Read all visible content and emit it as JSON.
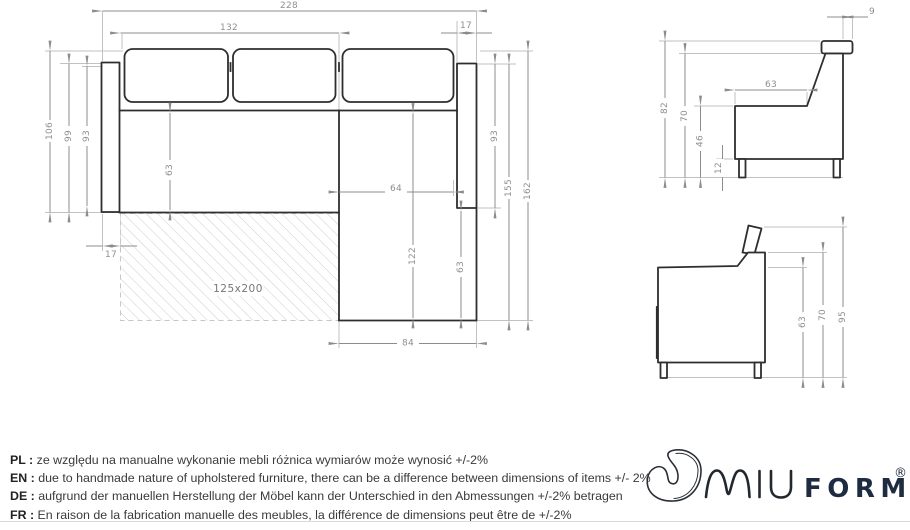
{
  "plan_view": {
    "bed_label": "125x200",
    "dims": {
      "total_width": "228",
      "back_cushions_width": "132",
      "right_armrest_width": "17",
      "left_armrest_width": "17",
      "left_depth_total": "106",
      "left_depth_inner": "99",
      "left_depth_seat": "93",
      "seat_depth": "63",
      "chaise_inner_width": "64",
      "right_depth": "93",
      "right_length_inner": "155",
      "right_length_total": "162",
      "chaise_inner_length": "122",
      "chaise_seat_length": "63",
      "chaise_width": "84"
    }
  },
  "side_view_back": {
    "dims": {
      "headrest_thickness": "9",
      "total_height": "82",
      "back_height": "70",
      "seat_depth": "63",
      "seat_height": "46",
      "leg_height": "12"
    }
  },
  "side_view_arm": {
    "dims": {
      "body_height": "63",
      "arm_height": "70",
      "total_height": "95"
    }
  },
  "notes": {
    "separator": " : ",
    "rows": [
      {
        "lang": "PL",
        "text": "ze względu na manualne wykonanie mebli różnica wymiarów może wynosić +/-2%"
      },
      {
        "lang": "EN",
        "text": "due to handmade nature of upholstered furniture, there can be a difference between dimensions of items +/- 2%"
      },
      {
        "lang": "DE",
        "text": "aufgrund der manuellen Herstellung der Möbel kann der Unterschied in den Abmessungen +/-2% betragen"
      },
      {
        "lang": "FR",
        "text": "En raison de la fabrication manuelle des meubles, la différence de dimensions peut être de +/-2%"
      }
    ]
  },
  "logo": {
    "brand": "MIUFORM",
    "miu_part": "MIU",
    "form_part": "FORM",
    "registered": "®",
    "color": "#1e2b40"
  },
  "colors": {
    "outline": "#2e2e2e",
    "dim_line": "#8c8c8c",
    "extension_line": "#c2c2c2",
    "dim_text": "#8f8f8f",
    "note_text": "#3a3a3a"
  }
}
